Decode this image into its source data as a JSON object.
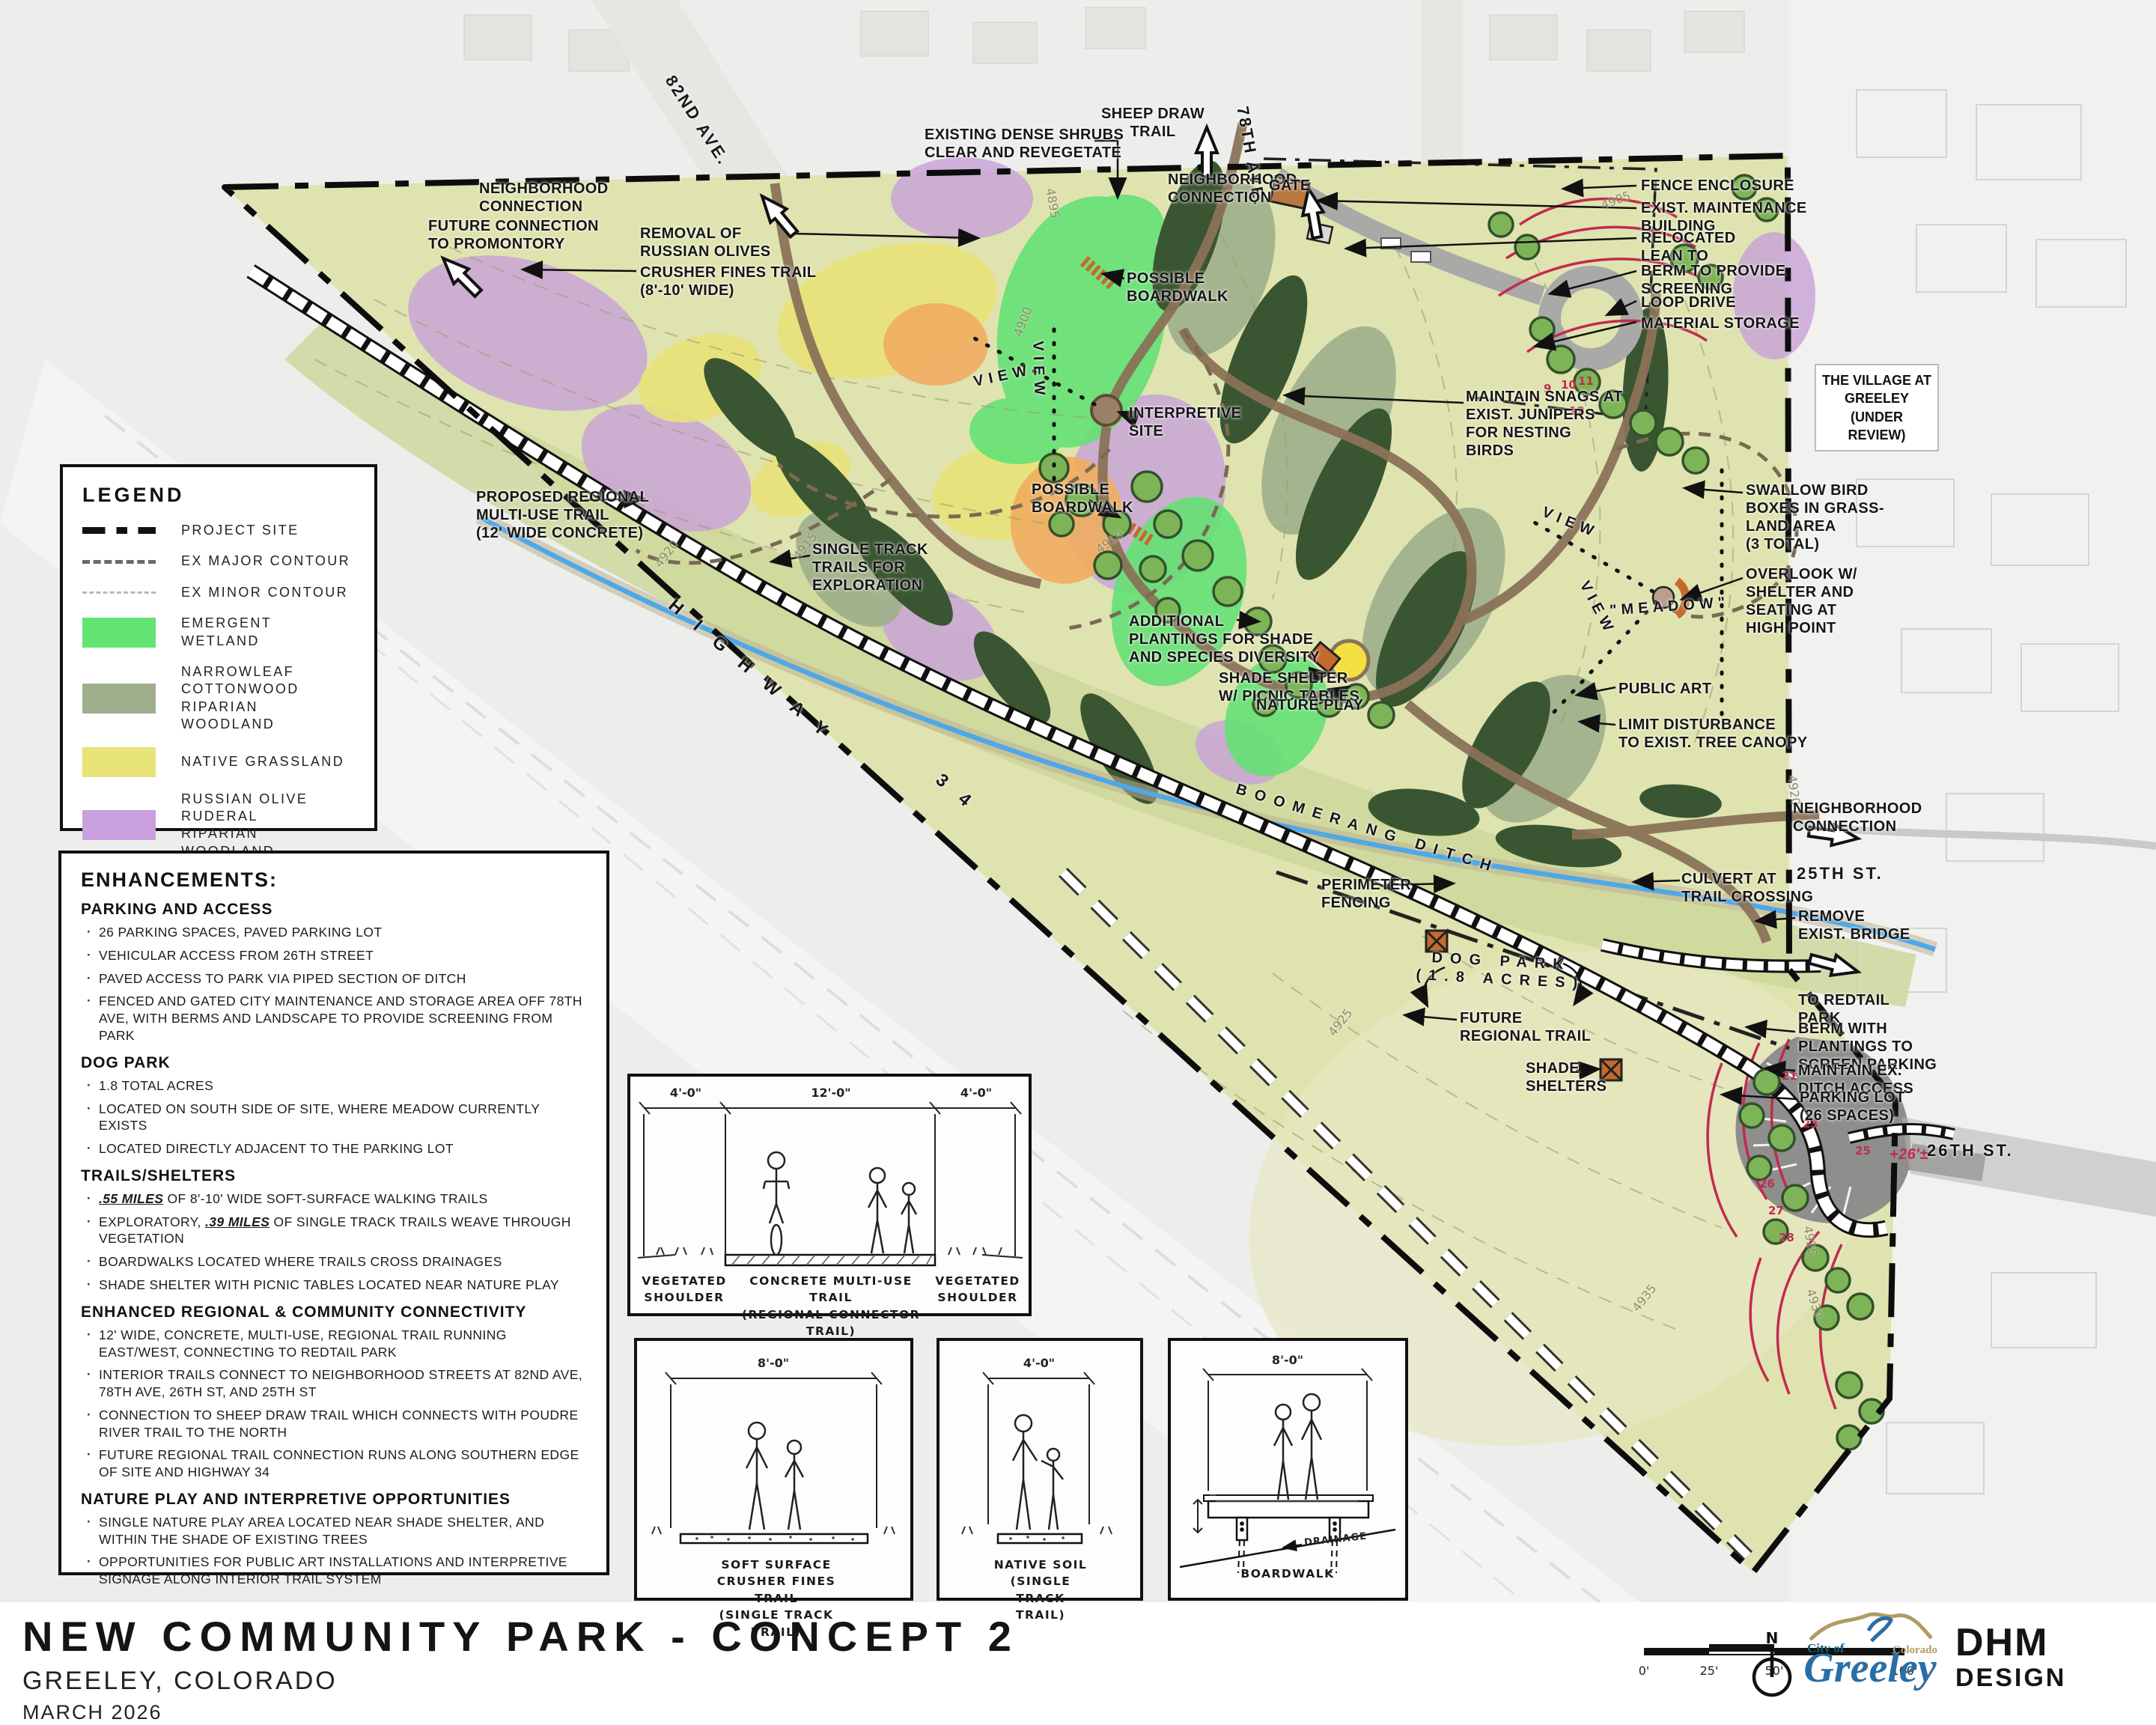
{
  "title_block": {
    "title": "NEW COMMUNITY PARK - CONCEPT 2",
    "location": "GREELEY, COLORADO",
    "date": "MARCH 2026"
  },
  "legend": {
    "title": "LEGEND",
    "line_items": [
      {
        "label": "PROJECT SITE"
      },
      {
        "label": "EX MAJOR CONTOUR"
      },
      {
        "label": "EX MINOR CONTOUR"
      }
    ],
    "area_items": [
      {
        "label": "EMERGENT WETLAND",
        "color": "#62e373"
      },
      {
        "label": "NARROWLEAF COTTONWOOD\nRIPARIAN WOODLAND",
        "color": "#9fae8d"
      },
      {
        "label": "NATIVE GRASSLAND",
        "color": "#e8e378"
      },
      {
        "label": "RUSSIAN OLIVE RUDERAL\nRIPARIAN WOODLAND",
        "color": "#c9a0dd"
      },
      {
        "label": "WILLOW SHRUBLAND",
        "color": "#f2b06c"
      }
    ]
  },
  "enhancements": {
    "title": "ENHANCEMENTS:",
    "sections": [
      {
        "heading": "PARKING AND ACCESS",
        "bullets": [
          {
            "text": "26 PARKING SPACES, PAVED PARKING LOT"
          },
          {
            "text": "VEHICULAR ACCESS FROM 26TH STREET"
          },
          {
            "text": "PAVED ACCESS TO PARK VIA PIPED SECTION OF DITCH"
          },
          {
            "text": "FENCED AND GATED CITY MAINTENANCE AND STORAGE AREA OFF 78TH AVE, WITH BERMS AND LANDSCAPE TO PROVIDE SCREENING FROM PARK"
          }
        ]
      },
      {
        "heading": "DOG PARK",
        "bullets": [
          {
            "text": "1.8 TOTAL ACRES"
          },
          {
            "text": "LOCATED ON SOUTH SIDE OF SITE, WHERE MEADOW CURRENTLY EXISTS"
          },
          {
            "text": "LOCATED DIRECTLY ADJACENT TO THE PARKING LOT"
          }
        ]
      },
      {
        "heading": "TRAILS/SHELTERS",
        "bullets": [
          {
            "em": ".55 MILES",
            "rest": " OF 8'-10' WIDE SOFT-SURFACE WALKING TRAILS"
          },
          {
            "pre": "EXPLORATORY, ",
            "em": ".39 MILES",
            "rest": " OF SINGLE TRACK TRAILS WEAVE THROUGH VEGETATION"
          },
          {
            "text": "BOARDWALKS LOCATED WHERE TRAILS CROSS DRAINAGES"
          },
          {
            "text": "SHADE SHELTER WITH PICNIC TABLES LOCATED NEAR NATURE PLAY"
          }
        ]
      },
      {
        "heading": "ENHANCED REGIONAL & COMMUNITY CONNECTIVITY",
        "bullets": [
          {
            "text": "12' WIDE, CONCRETE, MULTI-USE, REGIONAL TRAIL RUNNING EAST/WEST, CONNECTING TO REDTAIL PARK"
          },
          {
            "text": "INTERIOR TRAILS CONNECT TO NEIGHBORHOOD STREETS AT 82ND AVE, 78TH AVE, 26TH ST, AND 25TH ST"
          },
          {
            "text": "CONNECTION TO SHEEP DRAW TRAIL WHICH CONNECTS WITH POUDRE RIVER TRAIL TO THE NORTH"
          },
          {
            "text": "FUTURE REGIONAL TRAIL CONNECTION RUNS ALONG SOUTHERN EDGE OF SITE AND HIGHWAY 34"
          }
        ]
      },
      {
        "heading": "NATURE PLAY AND INTERPRETIVE OPPORTUNITIES",
        "bullets": [
          {
            "text": "SINGLE NATURE PLAY AREA LOCATED NEAR SHADE SHELTER, AND WITHIN THE SHADE OF EXISTING TREES"
          },
          {
            "text": "OPPORTUNITIES FOR PUBLIC ART INSTALLATIONS AND INTERPRETIVE SIGNAGE ALONG INTERIOR TRAIL SYSTEM"
          }
        ]
      }
    ]
  },
  "map": {
    "annotations": [
      {
        "text": "82ND AVE."
      },
      {
        "text": "NEIGHBORHOOD\nCONNECTION"
      },
      {
        "text": "FUTURE CONNECTION\nTO PROMONTORY"
      },
      {
        "text": "REMOVAL OF\nRUSSIAN OLIVES"
      },
      {
        "text": "CRUSHER FINES TRAIL\n(8'-10' WIDE)"
      },
      {
        "text": "EXISTING DENSE SHRUBS\nCLEAR AND REVEGETATE"
      },
      {
        "text": "SHEEP DRAW\nTRAIL"
      },
      {
        "text": "78TH AVE."
      },
      {
        "text": "NEIGHBORHOOD\nCONNECTION"
      },
      {
        "text": "GATE"
      },
      {
        "text": "FENCE ENCLOSURE"
      },
      {
        "text": "EXIST. MAINTENANCE\nBUILDING"
      },
      {
        "text": "RELOCATED\nLEAN TO"
      },
      {
        "text": "BERM TO PROVIDE\nSCREENING"
      },
      {
        "text": "LOOP DRIVE"
      },
      {
        "text": "MATERIAL STORAGE"
      },
      {
        "text": "THE VILLAGE AT\nGREELEY\n(UNDER REVIEW)"
      },
      {
        "text": "MAINTAIN SNAGS AT\nEXIST. JUNIPERS\nFOR NESTING\nBIRDS"
      },
      {
        "text": "SWALLOW BIRD\nBOXES IN GRASS-\nLAND AREA\n(3 TOTAL)"
      },
      {
        "text": "VIEW"
      },
      {
        "text": "VIEW"
      },
      {
        "text": "VIEW"
      },
      {
        "text": "VIEW"
      },
      {
        "text": "\"MEADOW\""
      },
      {
        "text": "OVERLOOK W/\nSHELTER AND\nSEATING AT\nHIGH POINT"
      },
      {
        "text": "POSSIBLE\nBOARDWALK"
      },
      {
        "text": "POSSIBLE\nBOARDWALK"
      },
      {
        "text": "INTERPRETIVE\nSITE"
      },
      {
        "text": "PROPOSED REGIONAL\nMULTI-USE TRAIL\n(12' WIDE CONCRETE)"
      },
      {
        "text": "SINGLE TRACK\nTRAILS FOR\nEXPLORATION"
      },
      {
        "text": "HIGHWAY"
      },
      {
        "text": "34"
      },
      {
        "text": "ADDITIONAL\nPLANTINGS FOR SHADE\nAND SPECIES DIVERSITY"
      },
      {
        "text": "SHADE SHELTER\nW/ PICNIC TABLES"
      },
      {
        "text": "NATURE PLAY"
      },
      {
        "text": "PUBLIC ART"
      },
      {
        "text": "LIMIT DISTURBANCE\nTO EXIST. TREE CANOPY"
      },
      {
        "text": "BOOMERANG DITCH"
      },
      {
        "text": "PERIMETER\nFENCING"
      },
      {
        "text": "DOG PARK\n(1.8 ACRES)"
      },
      {
        "text": "FUTURE\nREGIONAL TRAIL"
      },
      {
        "text": "SHADE\nSHELTERS"
      },
      {
        "text": "NEIGHBORHOOD\nCONNECTION"
      },
      {
        "text": "25TH ST."
      },
      {
        "text": "CULVERT AT\nTRAIL CROSSING"
      },
      {
        "text": "REMOVE\nEXIST. BRIDGE"
      },
      {
        "text": "TO REDTAIL\nPARK"
      },
      {
        "text": "BERM WITH\nPLANTINGS TO\nSCREEN PARKING"
      },
      {
        "text": "MAINTAIN EX.\nDITCH ACCESS"
      },
      {
        "text": "PARKING LOT\n(26 SPACES)"
      },
      {
        "text": "26TH ST."
      },
      {
        "text": "+26'±"
      }
    ],
    "contour_labels": [
      "4895",
      "4900",
      "4905",
      "4910",
      "4915",
      "4920",
      "4925",
      "4930",
      "4935"
    ],
    "grade_labels": [
      "9",
      "10",
      "11",
      "12",
      "21",
      "23",
      "25",
      "26",
      "27",
      "28"
    ],
    "colors": {
      "accent_red": "#c22a50",
      "ditch_blue": "#4fa8e6",
      "site_green": "#dfe3af"
    }
  },
  "sections": [
    {
      "dims": [
        "4'-0\"",
        "12'-0\"",
        "4'-0\""
      ],
      "labels": [
        "VEGETATED\nSHOULDER",
        "CONCRETE MULTI-USE TRAIL\n(REGIONAL CONNECTOR TRAIL)",
        "VEGETATED\nSHOULDER"
      ]
    },
    {
      "dims": [
        "8'-0\""
      ],
      "caption": "SOFT SURFACE CRUSHER FINES TRAIL\n(SINGLE TRACK TRAIL)"
    },
    {
      "dims": [
        "4'-0\""
      ],
      "caption": "NATIVE SOIL\n(SINGLE TRACK TRAIL)"
    },
    {
      "dims": [
        "8'-0\""
      ],
      "caption": "BOARDWALK",
      "note": "DRAINAGE"
    }
  ],
  "footer": {
    "scale_ticks": [
      "0'",
      "25'",
      "50'",
      "100'"
    ],
    "north_label": "N",
    "city_logo": {
      "city_of": "City of",
      "name": "Greeley",
      "state": "Colorado"
    },
    "firm": {
      "line1": "DHM",
      "line2": "DESIGN"
    }
  }
}
